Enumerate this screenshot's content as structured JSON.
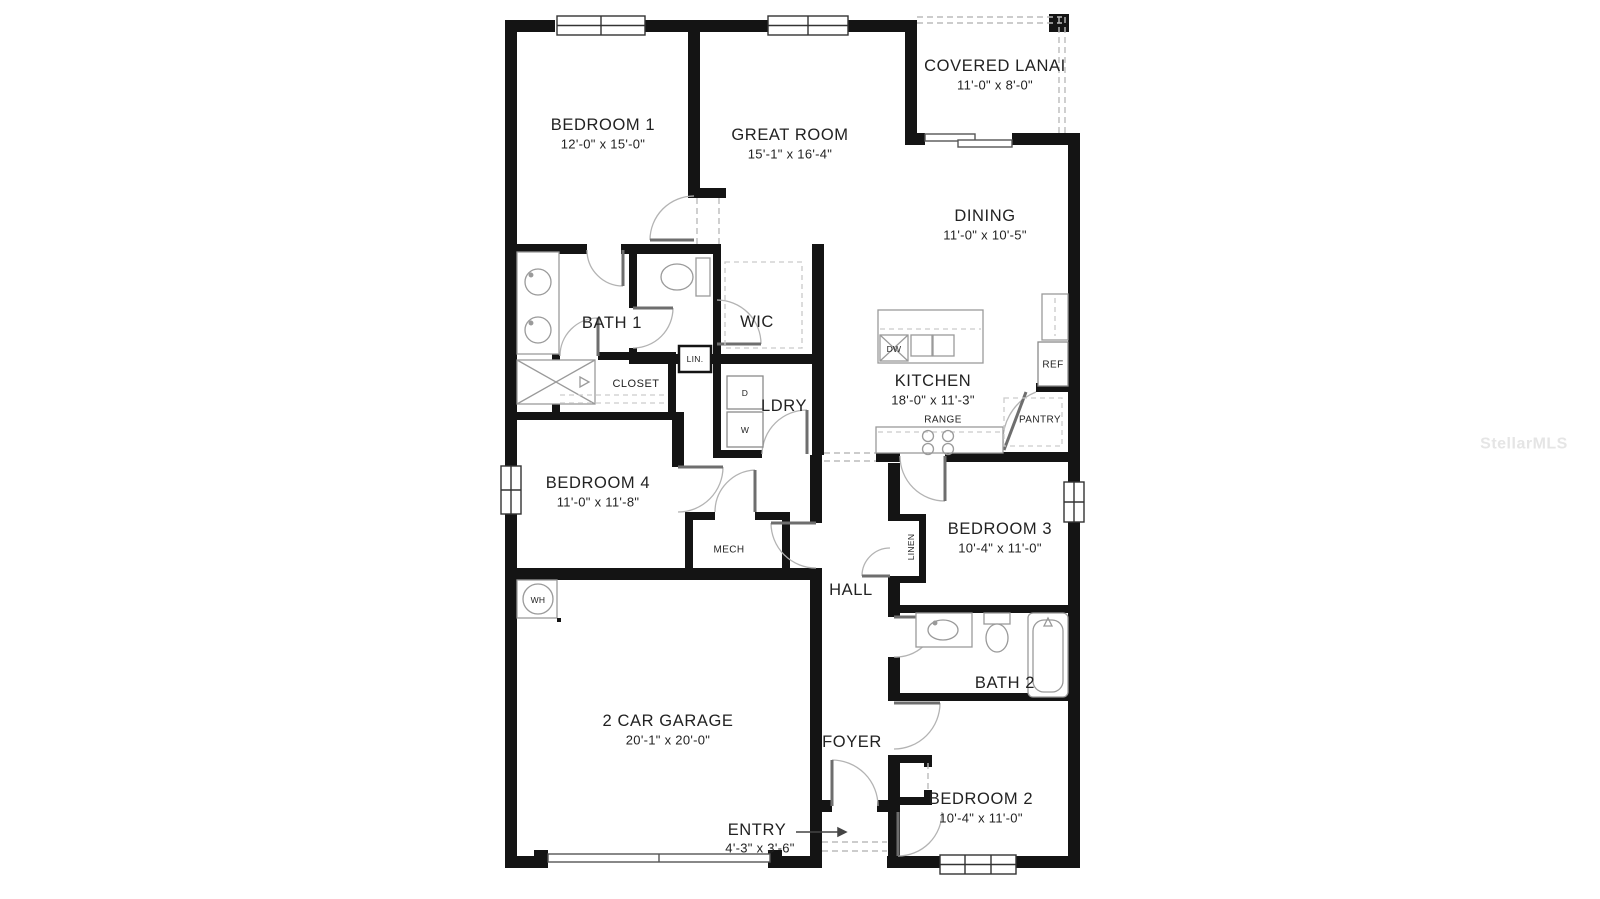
{
  "watermark": "StellarMLS",
  "colors": {
    "wall": "#141414",
    "background": "#ffffff",
    "fixture_line": "#9a9a9a",
    "door_arc": "#b3b3b3",
    "dashed_line": "#bbbbbb",
    "label_text": "#222222",
    "watermark_text": "#e5e5e5"
  },
  "floor_plan": {
    "rooms": [
      {
        "name": "COVERED LANAI",
        "dims": "11'-0\" x 8'-0\""
      },
      {
        "name": "BEDROOM 1",
        "dims": "12'-0\" x 15'-0\""
      },
      {
        "name": "GREAT ROOM",
        "dims": "15'-1\" x 16'-4\""
      },
      {
        "name": "DINING",
        "dims": "11'-0\" x 10'-5\""
      },
      {
        "name": "BATH 1",
        "dims": ""
      },
      {
        "name": "WIC",
        "dims": ""
      },
      {
        "name": "CLOSET",
        "dims": ""
      },
      {
        "name": "LIN.",
        "dims": ""
      },
      {
        "name": "LDRY",
        "dims": ""
      },
      {
        "name": "KITCHEN",
        "dims": "18'-0\" x 11'-3\""
      },
      {
        "name": "PANTRY",
        "dims": ""
      },
      {
        "name": "BEDROOM 4",
        "dims": "11'-0\" x 11'-8\""
      },
      {
        "name": "MECH",
        "dims": ""
      },
      {
        "name": "HALL",
        "dims": ""
      },
      {
        "name": "BEDROOM 3",
        "dims": "10'-4\" x 11'-0\""
      },
      {
        "name": "LINEN",
        "dims": ""
      },
      {
        "name": "BATH 2",
        "dims": ""
      },
      {
        "name": "2 CAR GARAGE",
        "dims": "20'-1\" x 20'-0\""
      },
      {
        "name": "FOYER",
        "dims": ""
      },
      {
        "name": "ENTRY",
        "dims": "4'-3\" x 3'-6\""
      },
      {
        "name": "BEDROOM 2",
        "dims": "10'-4\" x 11'-0\""
      }
    ],
    "fixtures": {
      "dishwasher": "DW",
      "refrigerator": "REF",
      "range": "RANGE",
      "dryer": "D",
      "washer": "W",
      "water_heater": "WH"
    }
  }
}
